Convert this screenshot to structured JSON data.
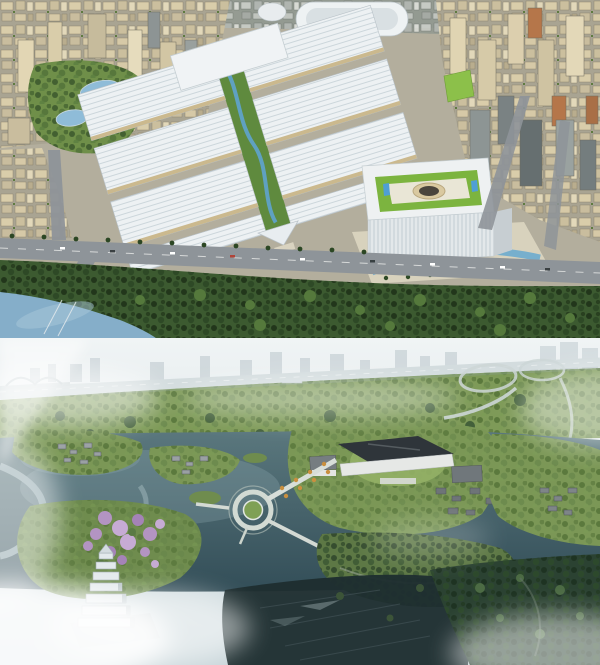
{
  "window": {
    "width": 600,
    "height": 665
  },
  "figures": [
    {
      "label": "Aerial rendering: large white exhibition center with parallel ribbed halls and a landscaped central spine, surrounded by dense beige city blocks, a park with two ponds, a white cube building with rooftop courtyard garden, a tree-lined boulevard and a river in the foreground",
      "palette": {
        "cityBase": "#b3ae9d",
        "hallRoof": "#edf1f3",
        "spineGreen": "#5f8a3e",
        "spineWater": "#5fa3cf",
        "parkGreen": "#6f8f49",
        "pond": "#8fbcd8",
        "road": "#8e9499",
        "treeBand": "#3c5a30",
        "river": "#85aec9",
        "plaza": "#d8d2bd",
        "courtyardLawn": "#7cb43f",
        "courtyardWater": "#4f9fd4",
        "courtyardCenter": "#d9c9a0",
        "canopy": "#f0f3f5"
      }
    },
    {
      "label": "Hazy aerial rendering: lakeside wetland park with green islands, traditional gray-roof building clusters, a grand dark-roof hall, a circular plaza with radiating paths, a pagoda amid purple blossom trees, winding streams, an elevated highway with interchange, faded skyline and drifting white mist",
      "palette": {
        "haze": "#e4eaec",
        "skyline": "#b6c2c8",
        "highway": "#d3dcde",
        "park": "#7e9a58",
        "lakeTop": "#5b787e",
        "lakeBottom": "#334e58",
        "island": "#7b9756",
        "roofDark": "#2f353a",
        "building": "#e6e8e6",
        "blossom": "#b394c2",
        "plazaRing": "#d2dad3",
        "forestDark": "#2b4232",
        "darkWater": "#1e2e30",
        "mist": "#ffffff"
      }
    }
  ]
}
